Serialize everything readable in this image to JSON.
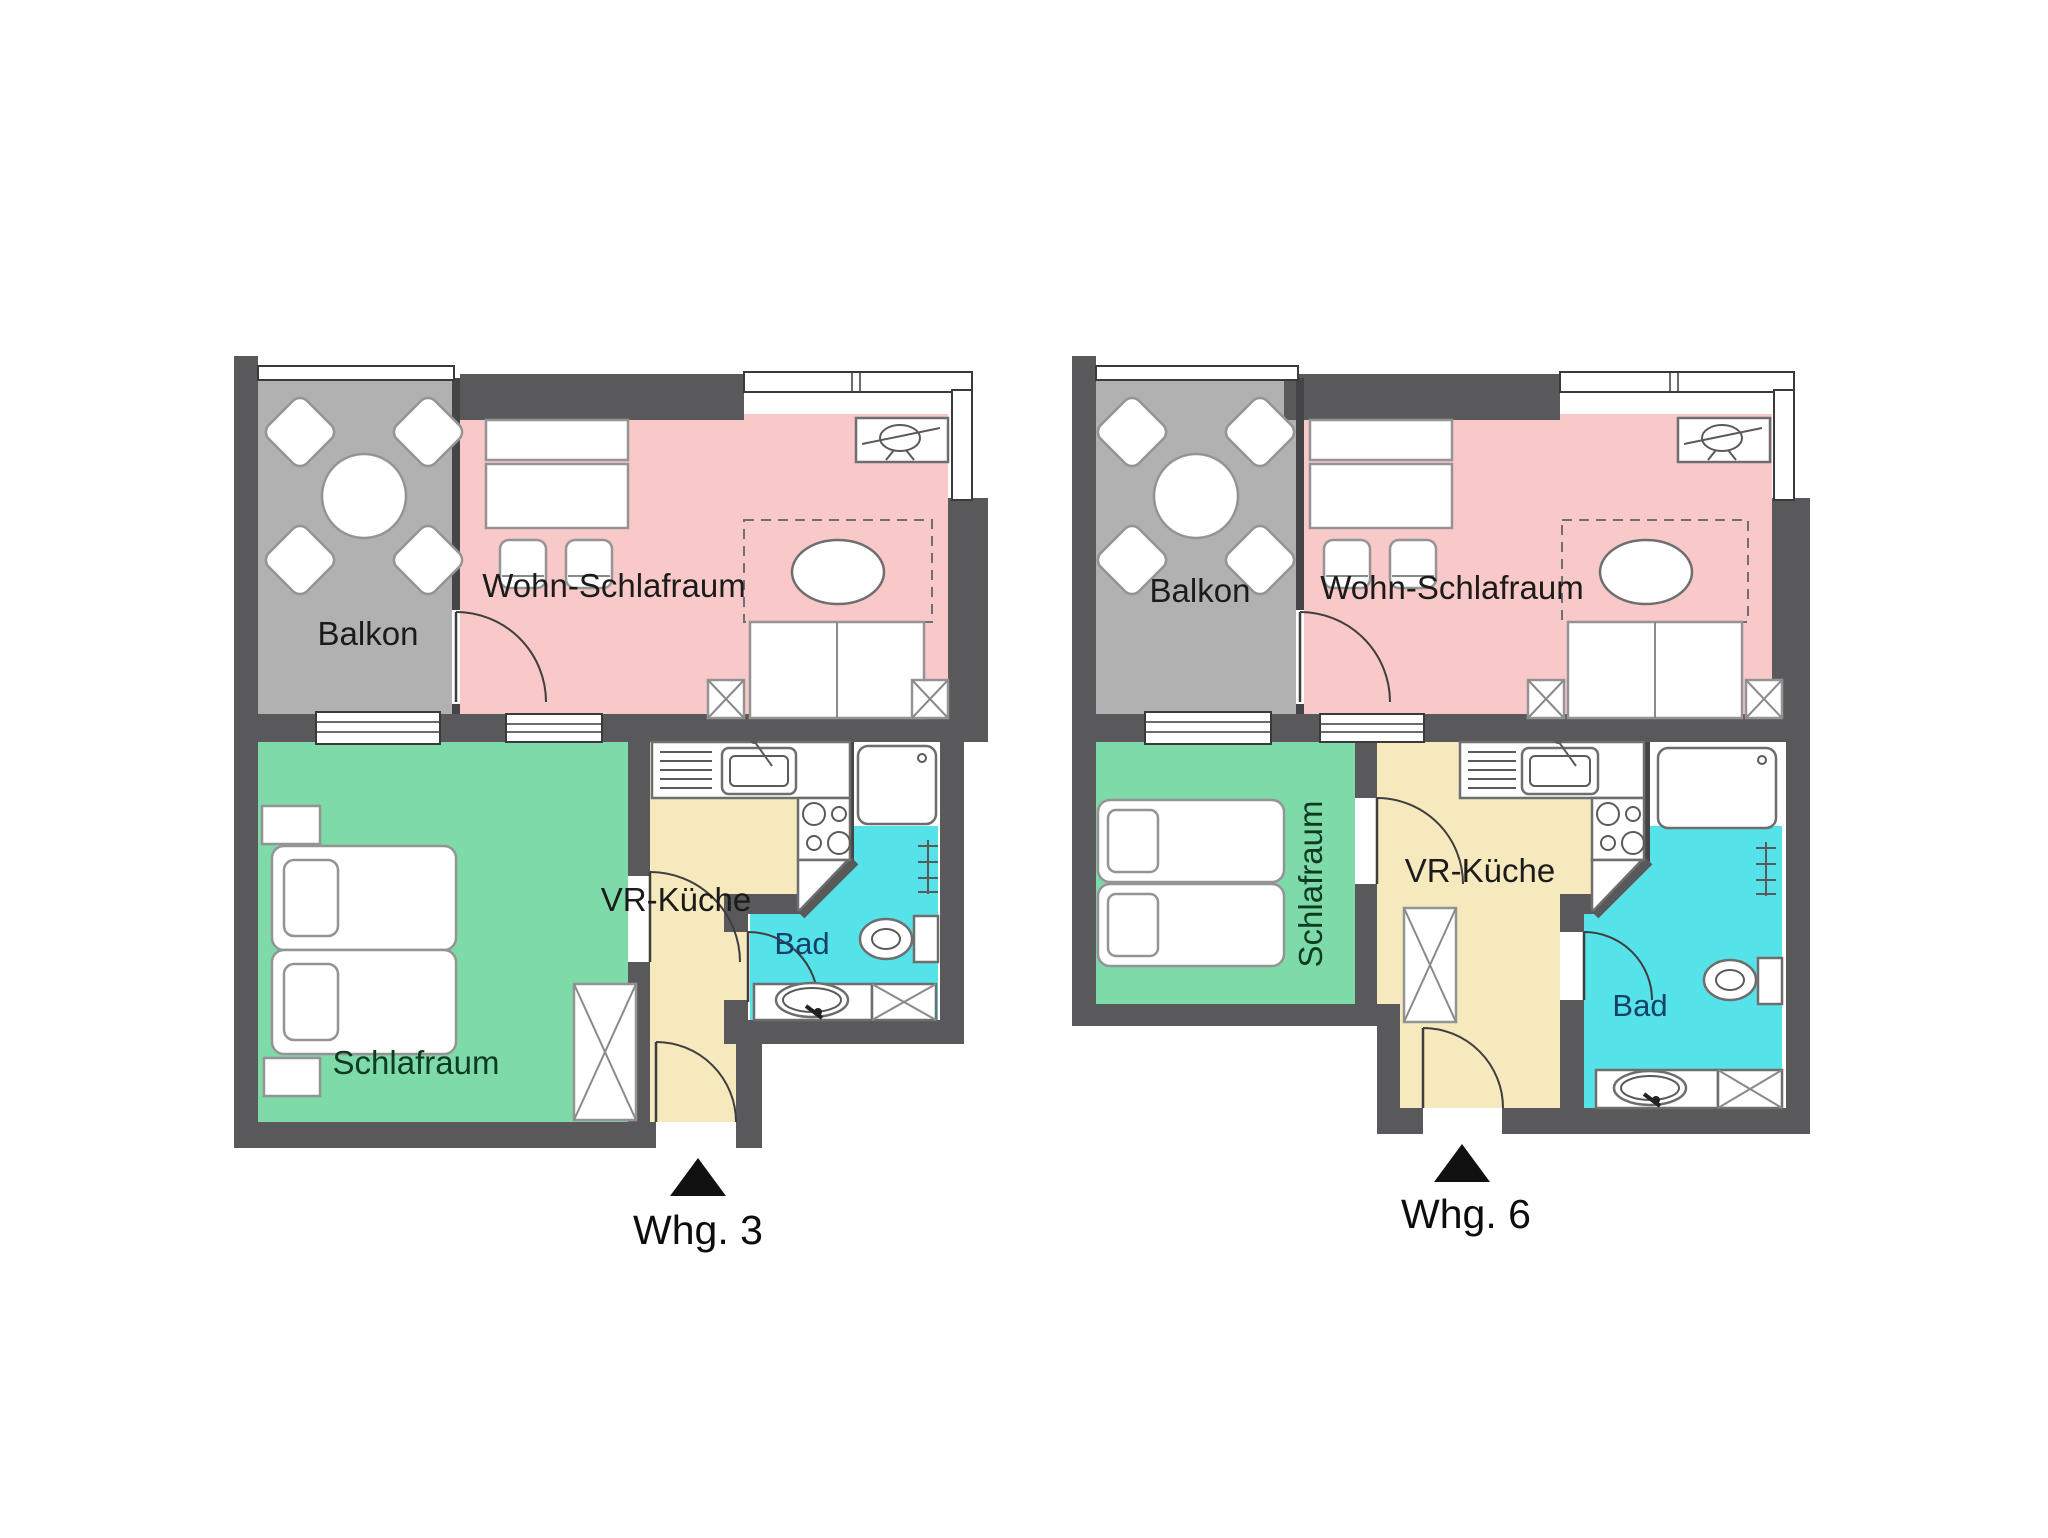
{
  "figure": "apartment-floor-plans",
  "colors": {
    "wall": "#59595b",
    "balcony": "#b1b1b1",
    "living": "#f9c8c8",
    "bedroom": "#7edaa8",
    "kitchen": "#f6e9bd",
    "bath": "#55e2e9",
    "label": "#1b1b1b",
    "bedroom_label": "#0e3c22",
    "bath_label": "#14406b"
  },
  "apartments": [
    {
      "name": "Whg. 3",
      "rooms": {
        "balcony": "Balkon",
        "living": "Wohn-Schlafraum",
        "bedroom": "Schlafraum",
        "hall_kitchen": "VR-Küche",
        "bath": "Bad"
      }
    },
    {
      "name": "Whg. 6",
      "rooms": {
        "balcony": "Balkon",
        "living": "Wohn-Schlafraum",
        "bedroom": "Schlafraum",
        "hall_kitchen": "VR-Küche",
        "bath": "Bad"
      }
    }
  ]
}
